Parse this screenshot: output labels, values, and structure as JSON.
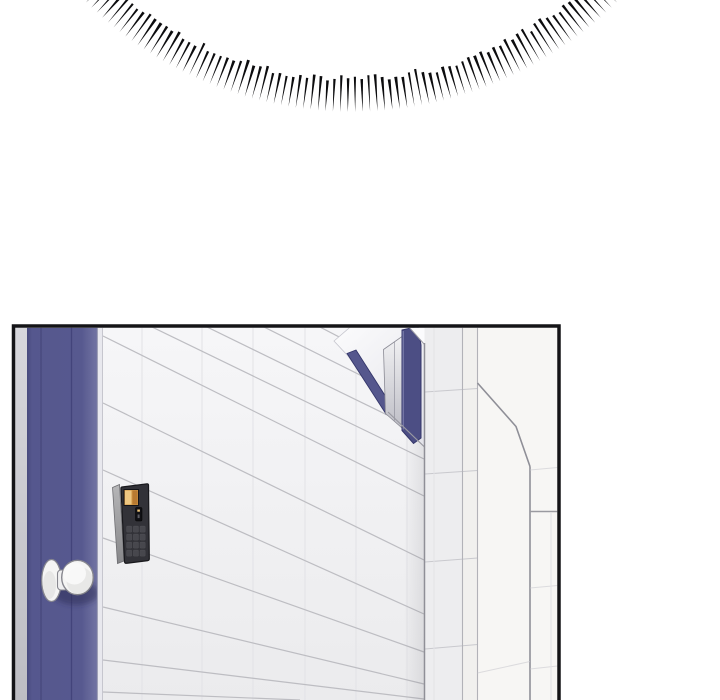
{
  "meta": {
    "kind": "comic-panel-page",
    "width": 720,
    "height": 700,
    "visible_text": "none"
  },
  "effects": {
    "speed_lines": {
      "name": "radial-burst-arc",
      "count": 80,
      "center_x": 351.5,
      "center_y": -265,
      "outer_radius": 377,
      "min_length": 29,
      "max_length": 37,
      "min_width": 2.1,
      "max_width": 3.1,
      "start_angle_deg": 45.2,
      "end_angle_deg": 134.8
    }
  },
  "panel": {
    "description": "Interior scene: navy blue door with round knob on the left, white tiled wall in steep perspective, wall-mounted keypad door lock with amber screen, navy-framed window, far tiled wall corner on the right.",
    "elements": [
      "gray-door-jamb",
      "navy-door",
      "door-knob",
      "keypad-lock",
      "tiled-main-wall",
      "navy-framed-window",
      "right-wall-corner-faces"
    ]
  },
  "colors": {
    "page_bg": "#ffffff",
    "panel_border": "#141417",
    "wall": "#f3f3f5",
    "wall_grout": "#bdbdc2",
    "wall_grout_faint": "#e2e2e6",
    "door": "#57598f",
    "door_edge": "#484a7d",
    "door_crease": "#43447b",
    "door_highlight": "#6e70a0",
    "frame_strip": "#e8e8ee",
    "gray_strip_top": "#d7d7dc",
    "gray_strip_bottom": "#b7b7bd",
    "corner_line": "#8f8f97",
    "face_a": "#ededef",
    "face_b": "#f1f0ee",
    "face_far": "#f7f6f4",
    "face_grout": "#c9c9ce",
    "navy_frame": "#4c4e84",
    "navy_band": "#55578d",
    "navy_outline": "#34366a",
    "glass_top": "#f1f1f3",
    "glass_bottom": "#bfbfc7",
    "keypad_front": "#323238",
    "keypad_side": "#a6a6a9",
    "keypad_screen": "#cf9443",
    "keypad_screen_light": "#eec781",
    "keypad_slot": "#101014",
    "key_fill": "#47474d",
    "knob_fill": "#f5f5f4",
    "knob_outline": "#87878f",
    "speed_line": "#0c0c0e"
  }
}
